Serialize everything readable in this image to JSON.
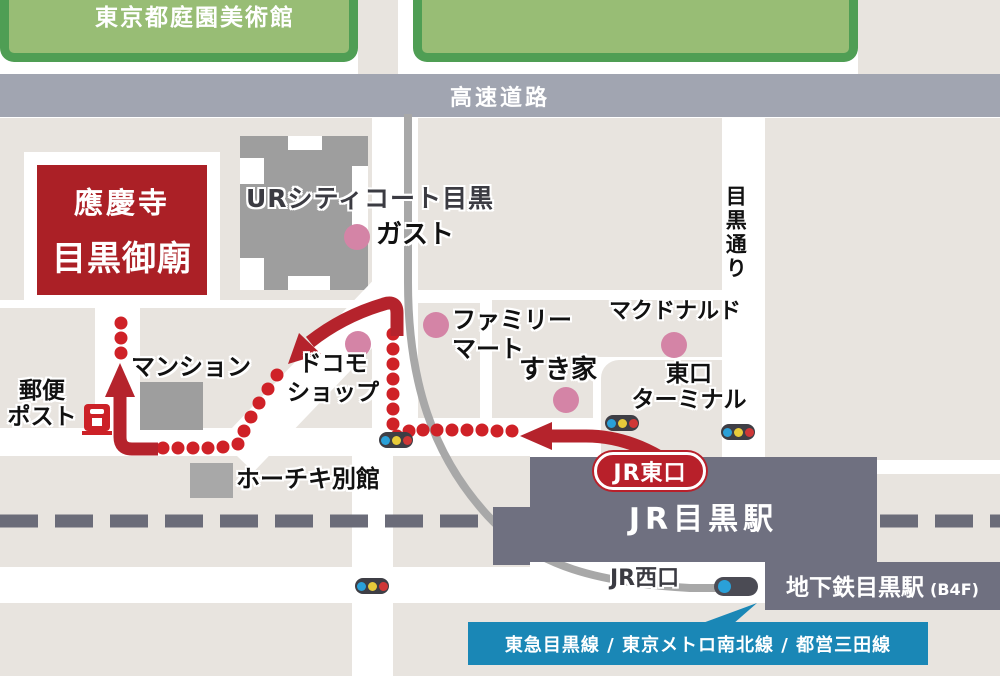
{
  "parks": {
    "teien_museum": "東京都庭園美術館"
  },
  "roads": {
    "expressway": "高速道路",
    "meguro_street": "目黒通り"
  },
  "destination": {
    "name_line1": "應慶寺",
    "name_line2": "目黒御廟"
  },
  "landmarks": {
    "ur_city_court": "URシティコート目黒",
    "gusto": "ガスト",
    "family_mart_line1": "ファミリー",
    "family_mart_line2": "マート",
    "mcdonalds": "マクドナルド",
    "sukiya": "すき家",
    "east_terminal_line1": "東口",
    "east_terminal_line2": "ターミナル",
    "mansion": "マンション",
    "docomo_line1": "ドコモ",
    "docomo_line2": "ショップ",
    "hochiki_annex": "ホーチキ別館",
    "post_box_line1": "郵便",
    "post_box_line2": "ポスト"
  },
  "station": {
    "jr_station": "JR目黒駅",
    "east_exit": "JR東口",
    "west_exit": "JR西口",
    "subway_station": "地下鉄目黒駅",
    "subway_floor": "(B4F)",
    "train_lines": "東急目黒線 / 東京メトロ南北線 / 都営三田線"
  },
  "colors": {
    "route_red": "#b5232c",
    "dot_red": "#cf2127",
    "destination_red": "#ab2026",
    "park_green": "#98bd75",
    "park_border_green": "#4f9e54",
    "expressway_gray": "#a1a5b1",
    "station_slate": "#6f7080",
    "line_band_blue": "#1a87b6",
    "block_beige": "#e8e4df",
    "poi_pink": "#d484a6"
  }
}
